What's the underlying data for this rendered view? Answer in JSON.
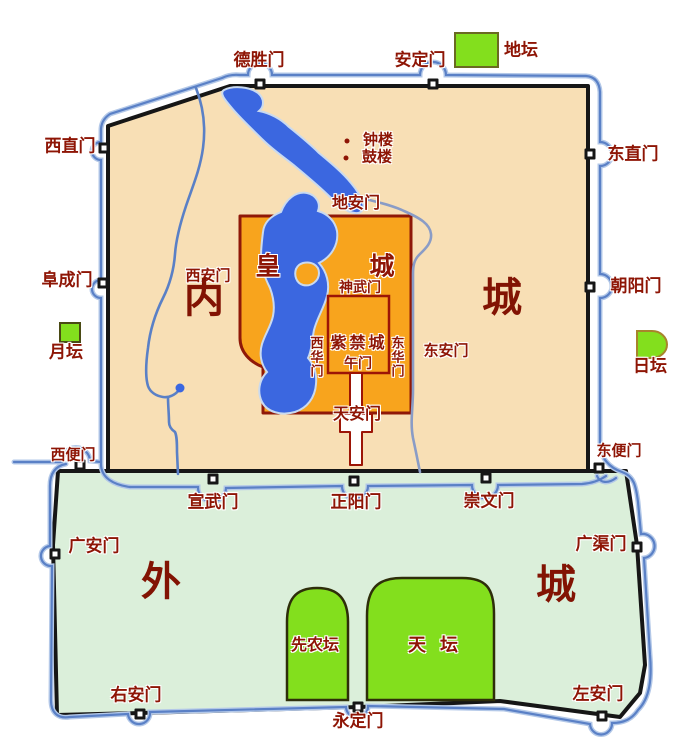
{
  "colors": {
    "inner_city_fill": "#f8dfb5",
    "outer_city_fill": "#dbefda",
    "imperial_city_fill": "#f8a41d",
    "altar_green": "#83df1d",
    "water_blue": "#3b67e0",
    "moat_blue": "#5a80c6",
    "moat_halo": "#b3c8e8",
    "canal_blue": "#8a9cc6",
    "wall_black": "#161616",
    "imperial_stroke": "#8f1808",
    "palace_stroke": "#9c1506",
    "label_red": "#8e1505"
  },
  "regions": {
    "inner_city": {
      "char1": "内",
      "char2": "城"
    },
    "outer_city": {
      "char1": "外",
      "char2": "城"
    },
    "imperial_city": {
      "char1": "皇",
      "char2": "城"
    },
    "forbidden_city": {
      "name": "紫禁城"
    }
  },
  "inner_gates": {
    "deshengmen": "德胜门",
    "andingmen": "安定门",
    "xizhimen": "西直门",
    "dongzhimen": "东直门",
    "fuchengmen": "阜成门",
    "chaoyangmen": "朝阳门",
    "xuanwumen": "宣武门",
    "zhengyangmen": "正阳门",
    "chongwenmen": "崇文门"
  },
  "outer_gates": {
    "xibianmen": "西便门",
    "dongbianmen": "东便门",
    "guanganmen": "广安门",
    "guangqumen": "广渠门",
    "youanmen": "右安门",
    "yongdingmen": "永定门",
    "zuoanmen": "左安门"
  },
  "imperial_gates": {
    "dianmen": "地安门",
    "xianmen": "西安门",
    "donganmen": "东安门",
    "tiananmen": "天安门"
  },
  "palace_gates": {
    "shenwumen": "神武门",
    "xihuamen": "西华门",
    "donghuamen": "东华门",
    "wumen": "午门"
  },
  "altars": {
    "ditan": "地坛",
    "yuetan": "月坛",
    "ritan": "日坛",
    "xiannongtan": "先农坛",
    "tiantan": "天坛"
  },
  "towers": {
    "zhonglou": "钟楼",
    "gulou": "鼓楼"
  }
}
